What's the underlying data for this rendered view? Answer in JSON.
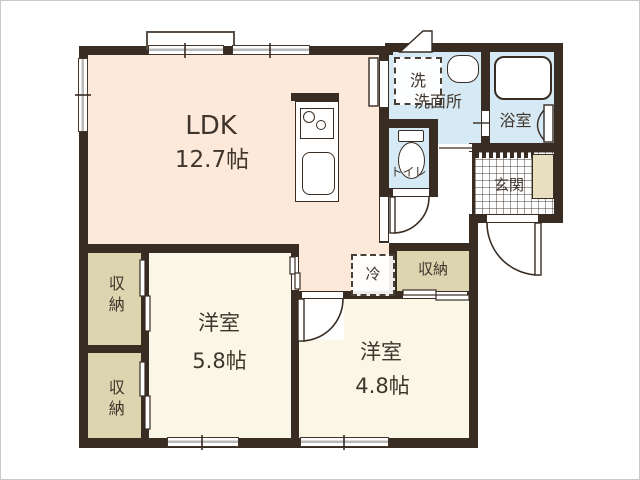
{
  "plan": {
    "title": "apartment-floor-plan",
    "rooms": {
      "ldk": {
        "label": "LDK",
        "area": "12.7帖"
      },
      "western_room_1": {
        "label": "洋室",
        "area": "5.8帖"
      },
      "western_room_2": {
        "label": "洋室",
        "area": "4.8帖"
      },
      "washroom": {
        "label": "洗面所"
      },
      "bathroom": {
        "label": "浴室"
      },
      "toilet": {
        "label": "トイレ"
      },
      "entrance": {
        "label": "玄関"
      },
      "storage_hall": {
        "label": "収納"
      },
      "closet_upper": {
        "label": "収納"
      },
      "closet_lower": {
        "label": "収納"
      }
    },
    "fixtures": {
      "washer_label": "洗",
      "refrigerator_label": "冷"
    },
    "colors": {
      "wall": "#382c23",
      "ldk_fill": "#fce9da",
      "western_room_fill": "#faf7e6",
      "wet_area_fill": "#d6eaf5",
      "storage_fill": "#ddd4b0",
      "entry_cabinet_fill": "#e7dfbe",
      "text": "#3f352c"
    }
  }
}
